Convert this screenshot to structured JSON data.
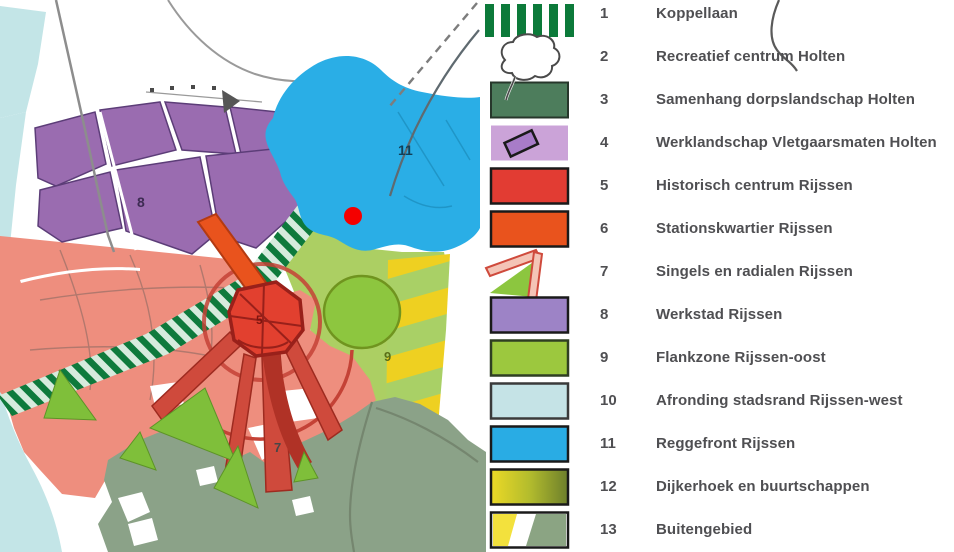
{
  "legend": {
    "items": [
      {
        "num": "1",
        "label": "Koppellaan",
        "swatch": "green-vertical-stripes",
        "color": "#0c7a3a"
      },
      {
        "num": "2",
        "label": "Recreatief centrum Holten",
        "swatch": "white-outline-blob",
        "color": "#ffffff"
      },
      {
        "num": "3",
        "label": "Samenhang dorpslandschap Holten",
        "swatch": "solid",
        "color": "#4d7d5c"
      },
      {
        "num": "4",
        "label": "Werklandschap Vletgaarsmaten Holten",
        "swatch": "lilac-with-dark-parcel",
        "color": "#cba3d8"
      },
      {
        "num": "5",
        "label": "Historisch centrum Rijssen",
        "swatch": "solid",
        "color": "#e23c33"
      },
      {
        "num": "6",
        "label": "Stationskwartier Rijssen",
        "swatch": "solid",
        "color": "#e9531d"
      },
      {
        "num": "7",
        "label": "Singels en radialen Rijssen",
        "swatch": "green-wedge-red-bars",
        "color": "#8cc63f"
      },
      {
        "num": "8",
        "label": "Werkstad Rijssen",
        "swatch": "solid",
        "color": "#9d83c6"
      },
      {
        "num": "9",
        "label": "Flankzone Rijssen-oost",
        "swatch": "solid",
        "color": "#9cc83e"
      },
      {
        "num": "10",
        "label": "Afronding stadsrand Rijssen-west",
        "swatch": "solid",
        "color": "#c5e3e6"
      },
      {
        "num": "11",
        "label": "Reggefront Rijssen",
        "swatch": "solid",
        "color": "#29ace4"
      },
      {
        "num": "12",
        "label": "Dijkerhoek en buurtschappen",
        "swatch": "yellow-olive-gradient",
        "colors": [
          "#ecd926",
          "#6d7f2c"
        ]
      },
      {
        "num": "13",
        "label": "Buitengebied",
        "swatch": "yellow-white-sage-diagonal",
        "colors": [
          "#f3e13d",
          "#ffffff",
          "#8ba483"
        ]
      }
    ]
  },
  "map": {
    "labels": {
      "werkstad": "8",
      "reggefront": "11",
      "flankzone": "9",
      "singels": "7",
      "centrum": "5"
    },
    "marker": {
      "type": "red-dot",
      "color": "#f40000",
      "x": 353,
      "y": 216
    },
    "colors": {
      "water_band": "#c3e5e7",
      "werkstad_purple": "#9a6cb0",
      "residential_salmon": "#ee8e7e",
      "reggefront_blue": "#2aaee6",
      "flankzone_green": "#accf63",
      "circle_green": "#8dc63f",
      "dijkerhoek_yellow": "#eed021",
      "buitengebied_sage": "#8ba288",
      "historic_red": "#e2402f",
      "station_orange": "#e9531d",
      "hatch_green": "#0e7a3c"
    }
  }
}
